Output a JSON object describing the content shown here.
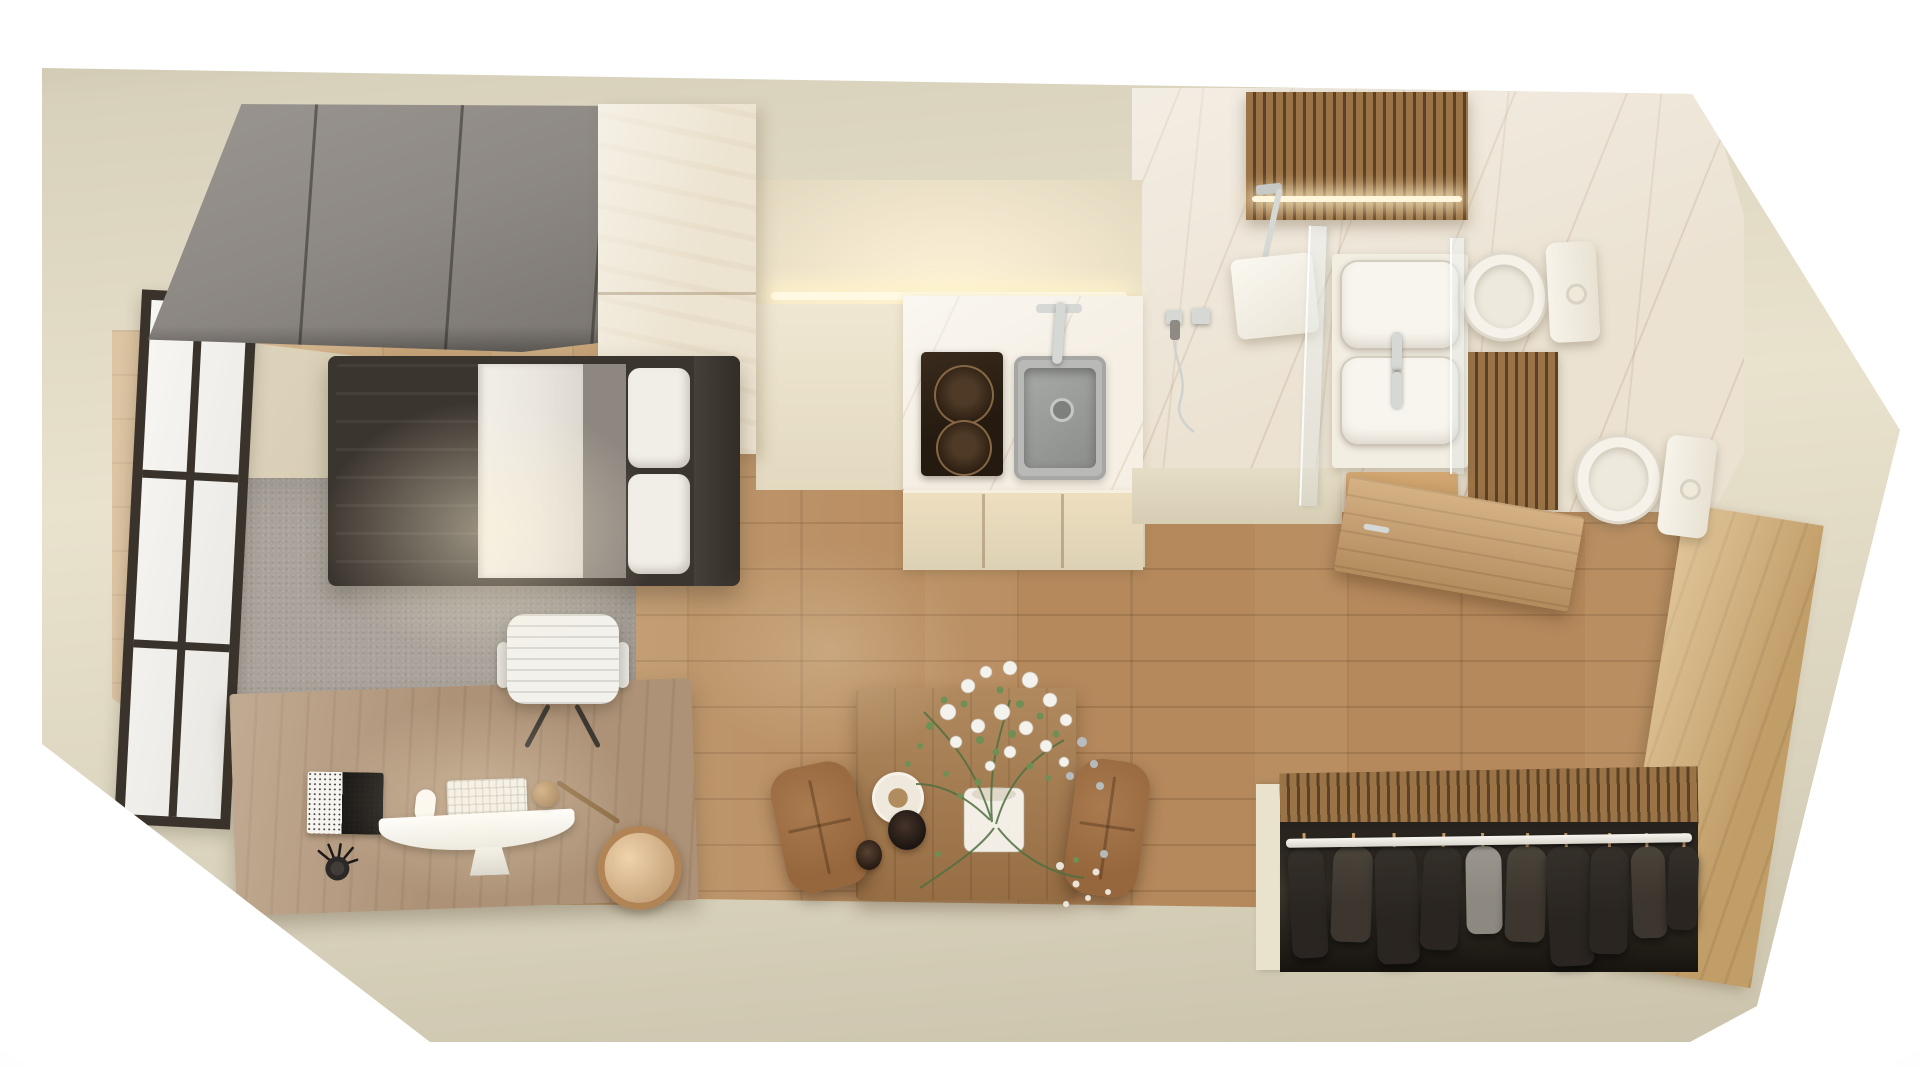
{
  "scene": {
    "type": "3d-floorplan-render",
    "view": "top-down",
    "subject": "studio apartment",
    "rooms": [
      {
        "name": "sleeping-area",
        "furniture": [
          "sliding-wardrobe",
          "single-bed",
          "area-rug",
          "office-chair",
          "desk",
          "window"
        ],
        "desk_items": [
          "imac-monitor",
          "keyboard",
          "mouse",
          "notebook",
          "pen-cup",
          "brass-desk-lamp"
        ]
      },
      {
        "name": "kitchen",
        "furniture": [
          "tall-cabinet",
          "marble-counter",
          "induction-cooktop",
          "sink",
          "faucet",
          "lower-cabinets",
          "under-cabinet-light"
        ],
        "burner_count": 2
      },
      {
        "name": "dining-area",
        "furniture": [
          "wood-table",
          "leather-chair-left",
          "leather-chair-right",
          "plate",
          "coffee-cup",
          "espresso-cup",
          "flower-vase"
        ]
      },
      {
        "name": "bathroom",
        "furniture": [
          "rain-shower",
          "hand-shower-controls",
          "glass-partition",
          "double-basin-vanity",
          "toilet-top",
          "toilet-bottom",
          "wood-slat-ceiling",
          "led-strip",
          "open-wood-door"
        ],
        "basin_count": 2,
        "toilet_count": 2
      },
      {
        "name": "entry-hall",
        "furniture": [
          "wood-console"
        ]
      },
      {
        "name": "open-closet",
        "furniture": [
          "clothes-rail",
          "hanging-garments",
          "slat-back-panel"
        ]
      }
    ],
    "closet": {
      "garments": [
        {
          "shade": "dark",
          "left": 8,
          "width": 36,
          "height": 112,
          "tilt": -3
        },
        {
          "shade": "mid",
          "left": 50,
          "width": 40,
          "height": 96,
          "tilt": 2
        },
        {
          "shade": "dark",
          "left": 94,
          "width": 42,
          "height": 118,
          "tilt": -2
        },
        {
          "shade": "dark",
          "left": 140,
          "width": 38,
          "height": 104,
          "tilt": 3
        },
        {
          "shade": "gray",
          "left": 184,
          "width": 36,
          "height": 88,
          "tilt": -1
        },
        {
          "shade": "mid",
          "left": 224,
          "width": 40,
          "height": 96,
          "tilt": 2
        },
        {
          "shade": "dark",
          "left": 266,
          "width": 44,
          "height": 120,
          "tilt": -3
        },
        {
          "shade": "dark",
          "left": 308,
          "width": 38,
          "height": 108,
          "tilt": 1
        },
        {
          "shade": "mid",
          "left": 350,
          "width": 34,
          "height": 92,
          "tilt": -2
        },
        {
          "shade": "dark",
          "left": 386,
          "width": 30,
          "height": 84,
          "tilt": 2
        }
      ]
    }
  },
  "colors": {
    "background": "#ffffff",
    "wall": "#d8d1bb",
    "wallLight": "#e9e2cd",
    "wallShade": "#c9c1a9",
    "floorWood": "#b5895c",
    "floorWoodLight": "#c7a478",
    "rug": "#a9a39b",
    "wardrobeGray": "#8e8984",
    "wardrobeGrayDark": "#76716c",
    "bedFrame": "#3b352f",
    "headboard": "#46403a",
    "duvetGray": "#9c958d",
    "sheetWhite": "#eae6df",
    "blanketGray": "#8e8780",
    "pillowWhite": "#f1eee8",
    "chairWhite": "#f3f1ec",
    "deskWood": "#ad9277",
    "notebookBlack": "#171412",
    "brass": "#b08455",
    "cabinetAsh": "#ece3d0",
    "cabinetAshDark": "#ddd1b5",
    "glowWarm": "#fdf3d8",
    "marbleCounter": "#f5efe4",
    "cooktopDark": "#241a10",
    "sinkGray": "#9fa19e",
    "chrome": "#d5d8d5",
    "marbleBath": "#ebe2d2",
    "slatWood": "#9a7347",
    "slatGap": "#5c4124",
    "fixtureWhite": "#f6f2e9",
    "glassTint": "#eef3f2",
    "doorWood": "#c79c68",
    "tableWood": "#a3774a",
    "leatherBrown": "#96663c",
    "clothesDark": "#2a2520",
    "clothesMid": "#3c362e",
    "clothesGray": "#8d8880",
    "railWhite": "#f2f0ea",
    "hangerTan": "#c9a06a",
    "leafGreen": "#6f8f55",
    "leafDark": "#4f7040",
    "flowerWhite": "#f4f2ec",
    "budBlue": "#b9c3c9",
    "windowFrame": "#3a332b"
  }
}
